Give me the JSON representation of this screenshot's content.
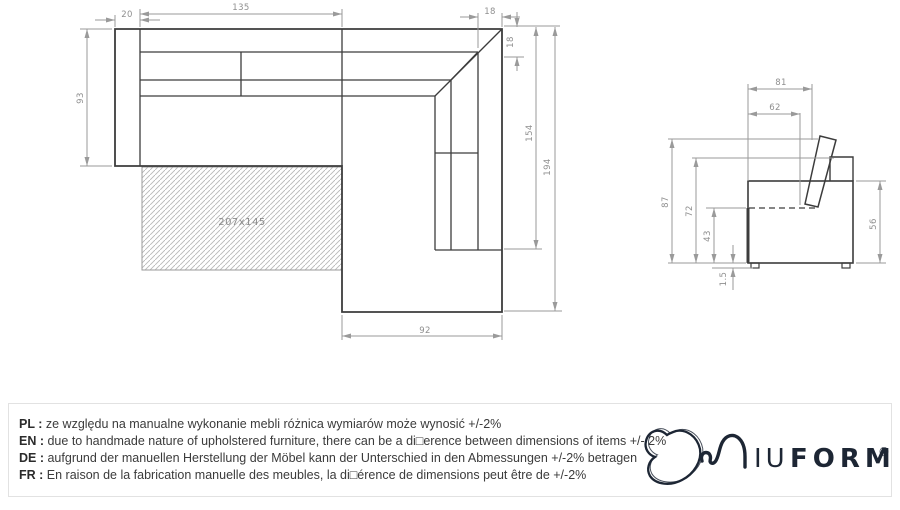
{
  "plan_view": {
    "sleeping_area_label": "207x145",
    "dims": {
      "seat_width": "135",
      "armrest_width": "20",
      "corner_width": "18",
      "corner_depth": "18",
      "side_length_inner": "154",
      "side_length_total": "194",
      "depth_left": "93",
      "chaise_width": "92"
    }
  },
  "side_view": {
    "dims": {
      "depth_total": "81",
      "seat_depth": "62",
      "height_total": "87",
      "backrest_height": "72",
      "seat_height": "43",
      "legs_height": "1.5",
      "arm_height": "56"
    }
  },
  "disclaimer": {
    "rows": [
      {
        "label": "PL :",
        "text": "ze względu na manualne wykonanie mebli różnica wymiarów może wynosić +/-2%"
      },
      {
        "label": "EN :",
        "text": "due to handmade nature of upholstered furniture, there can be a di□erence between dimensions of items +/- 2%"
      },
      {
        "label": "DE :",
        "text": "aufgrund der manuellen Herstellung der Möbel kann der Unterschied in den Abmessungen +/-2% betragen"
      },
      {
        "label": "FR :",
        "text": "En raison de la fabrication manuelle des meubles, la di□érence de dimensions peut être de +/-2%"
      }
    ]
  },
  "logo": {
    "word_light": "IU",
    "word_bold": "FORM",
    "registered": "®"
  },
  "colors": {
    "line_dark": "#3c3c3c",
    "line_dim": "#9a9a9a",
    "hatch": "#b8b8b8",
    "brand_navy": "#1d2634"
  }
}
